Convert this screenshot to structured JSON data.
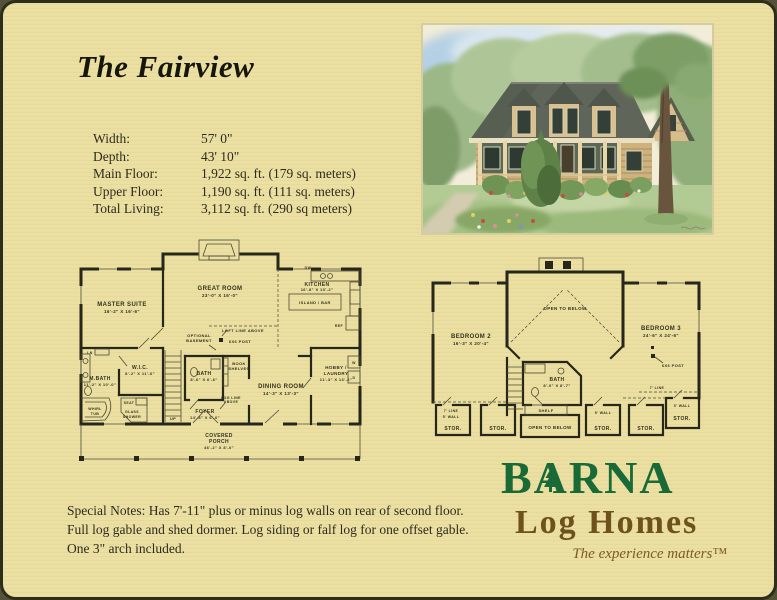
{
  "page": {
    "title": "The Fairview"
  },
  "specs": {
    "rows": [
      {
        "label": "Width:",
        "value": "57' 0\""
      },
      {
        "label": "Depth:",
        "value": "43' 10\""
      },
      {
        "label": "Main Floor:",
        "value": "1,922 sq. ft. (179 sq. meters)"
      },
      {
        "label": "Upper Floor:",
        "value": "1,190 sq. ft. (111 sq. meters)"
      },
      {
        "label": "Total Living:",
        "value": "3,112 sq. ft. (290 sq meters)"
      }
    ]
  },
  "main_floor": {
    "rooms": [
      {
        "name": "MASTER SUITE",
        "dim": "16'-2\" X 16'-6\""
      },
      {
        "name": "GREAT ROOM",
        "dim": "23'-0\" X 16'-0\""
      },
      {
        "name": "KITCHEN",
        "dim": "16'-8\" X 13'-2\""
      },
      {
        "name": "W.I.C.",
        "dim": "8'-2\" X 11'-6\""
      },
      {
        "name": "M.BATH",
        "dim": "11'-2\" X 10'-0\""
      },
      {
        "name": "BATH",
        "dim": "8'-6\" X 6'-6\""
      },
      {
        "name": "FOYER",
        "dim": "14'-8\" X 6'-0\""
      },
      {
        "name": "DINING ROOM",
        "dim": "14'-3\" X 13'-3\""
      },
      {
        "name": "HOBBY /",
        "name2": "LAUNDRY",
        "dim": "11'-3\" X 13'-2\""
      },
      {
        "name": "COVERED",
        "name2": "PORCH",
        "dim": "46'-2\" X 8'-0\""
      }
    ],
    "labels": {
      "dw": "DW",
      "island": "ISLAND / BAR",
      "ref": "REF",
      "loft_line": "LOFT LINE ABOVE",
      "post": "6X6 POST",
      "opt1": "OPTIONAL",
      "opt2": "BASEMENT",
      "book1": "BOOK",
      "book2": "SHELVES",
      "seat": "SEAT",
      "glass1": "GLASS",
      "glass2": "SHOWER",
      "whirl1": "WHIRL",
      "whirl2": "TUB",
      "log1": "LOG LINE",
      "log2": "ABOVE",
      "up": "UP",
      "ln": "LN",
      "w": "W",
      "d": "D"
    }
  },
  "upper_floor": {
    "rooms": [
      {
        "name": "BEDROOM 2",
        "dim": "16'-3\" X 20'-4\""
      },
      {
        "name": "BEDROOM 3",
        "dim": "24'-6\" X 24'-6\""
      },
      {
        "name": "BATH",
        "dim": "8'-0\" X 8'-7\""
      }
    ],
    "labels": {
      "open_below": "OPEN TO BELOW",
      "shelf": "SHELF",
      "post": "6X6 POST",
      "stor": "STOR.",
      "wall5": "5' WALL",
      "line7": "7' LINE"
    }
  },
  "notes": "Special Notes: Has 7'-11\" plus or minus log walls on rear of second floor. Full log gable and shed dormer. Log siding or falf log for one offset gable. One 3\" arch included.",
  "logo": {
    "brand": "BARNA",
    "sub": "Log Homes",
    "tagline": "The experience matters™",
    "green": "#1a6a38",
    "brown": "#6e521c"
  }
}
